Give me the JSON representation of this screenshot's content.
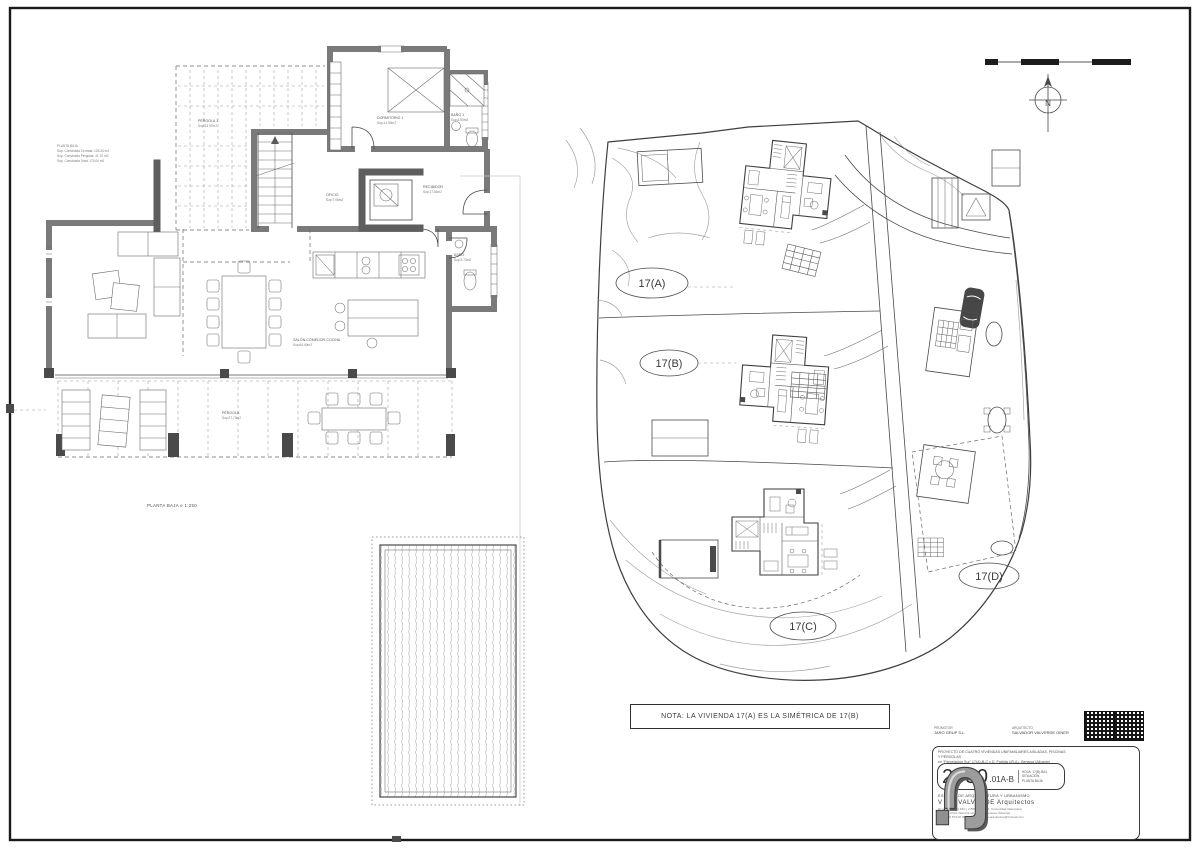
{
  "colors": {
    "paper": "#ffffff",
    "frame": "#1a1a1a",
    "line": "#3f3f3f",
    "wall": "#7a7a7a",
    "column": "#4a4a4a"
  },
  "floor_plan": {
    "caption": "PLANTA BAJA  e 1:250",
    "summary_lines": [
      "PLANTA BAJA",
      "Sup. Construida Cerrada: 128.34 m2",
      "Sup. Construida Pérgolas: 41.70 m2",
      "Sup. Construida Total: 170.04 m2"
    ],
    "rooms": {
      "pergola1": {
        "name": "PÉRGOLA 1",
        "area": "Sup:13.97m2"
      },
      "dormitorio1": {
        "name": "DORMITORIO 1",
        "area": "Sup:14.50m2"
      },
      "bano1": {
        "name": "BAÑO 1",
        "area": "Sup:4.50m2"
      },
      "oficio": {
        "name": "OFICIO",
        "area": "Sup:7.06m2"
      },
      "recibidor": {
        "name": "RECIBIDOR",
        "area": "Sup:17.84m2"
      },
      "aseo": {
        "name": "ASEO",
        "area": "Sup:3.73m2"
      },
      "salon": {
        "name": "SALÓN-COMEDOR-COCINA",
        "area": "Sup:64.40m2"
      },
      "pergola2": {
        "name": "PÉRGOLA",
        "area": "Sup:27.73m2"
      }
    }
  },
  "site_plan": {
    "plot_a": "17(A)",
    "plot_b": "17(B)",
    "plot_c": "17(C)",
    "plot_d": "17(D)"
  },
  "north_label": "N",
  "note": {
    "text": "NOTA: LA VIVIENDA 17(A) ES LA SIMÉTRICA DE 17(B)"
  },
  "title_block": {
    "promoter_label": "PROMOTOR",
    "promoter_name": "JARO GRUP S.L.",
    "architect_label": "ARQUITECTO",
    "architect_name": "SALVADOR VALVERDE GINER",
    "description_line1": "PROYECTO DE CUATRO VIVIENDAS UNIFAMILIARES AISLADAS, PISCINAS Y PÉRGOLAS",
    "description_line2": "en \"Parcelación Sur\" 17(A)-B-C y D, Partida UR.A.j, Benissa (Alicante)",
    "drawing_number": "2350",
    "drawing_suffix": ".01A-B",
    "hoja": "HOJA: 17(B)-BA1",
    "situacion": "SITUACIÓN",
    "planta": "PLANTA BAJA",
    "studio": "ESTUDIO DE ARQUITECTURA Y URBANISMO",
    "architects": "V & J VALVERDE  Arquitectos",
    "address1": "Nº colegiados 1.184 y 2.883 del C.O.A. Comunidad Valenciana",
    "address2": "Avda. del País Valencià s/n - 03720 Benissa (Alicante)",
    "contact": "tel/fax: 96 573 00 00 - e-mail: valverde.arquitectos@hotmail.com"
  }
}
